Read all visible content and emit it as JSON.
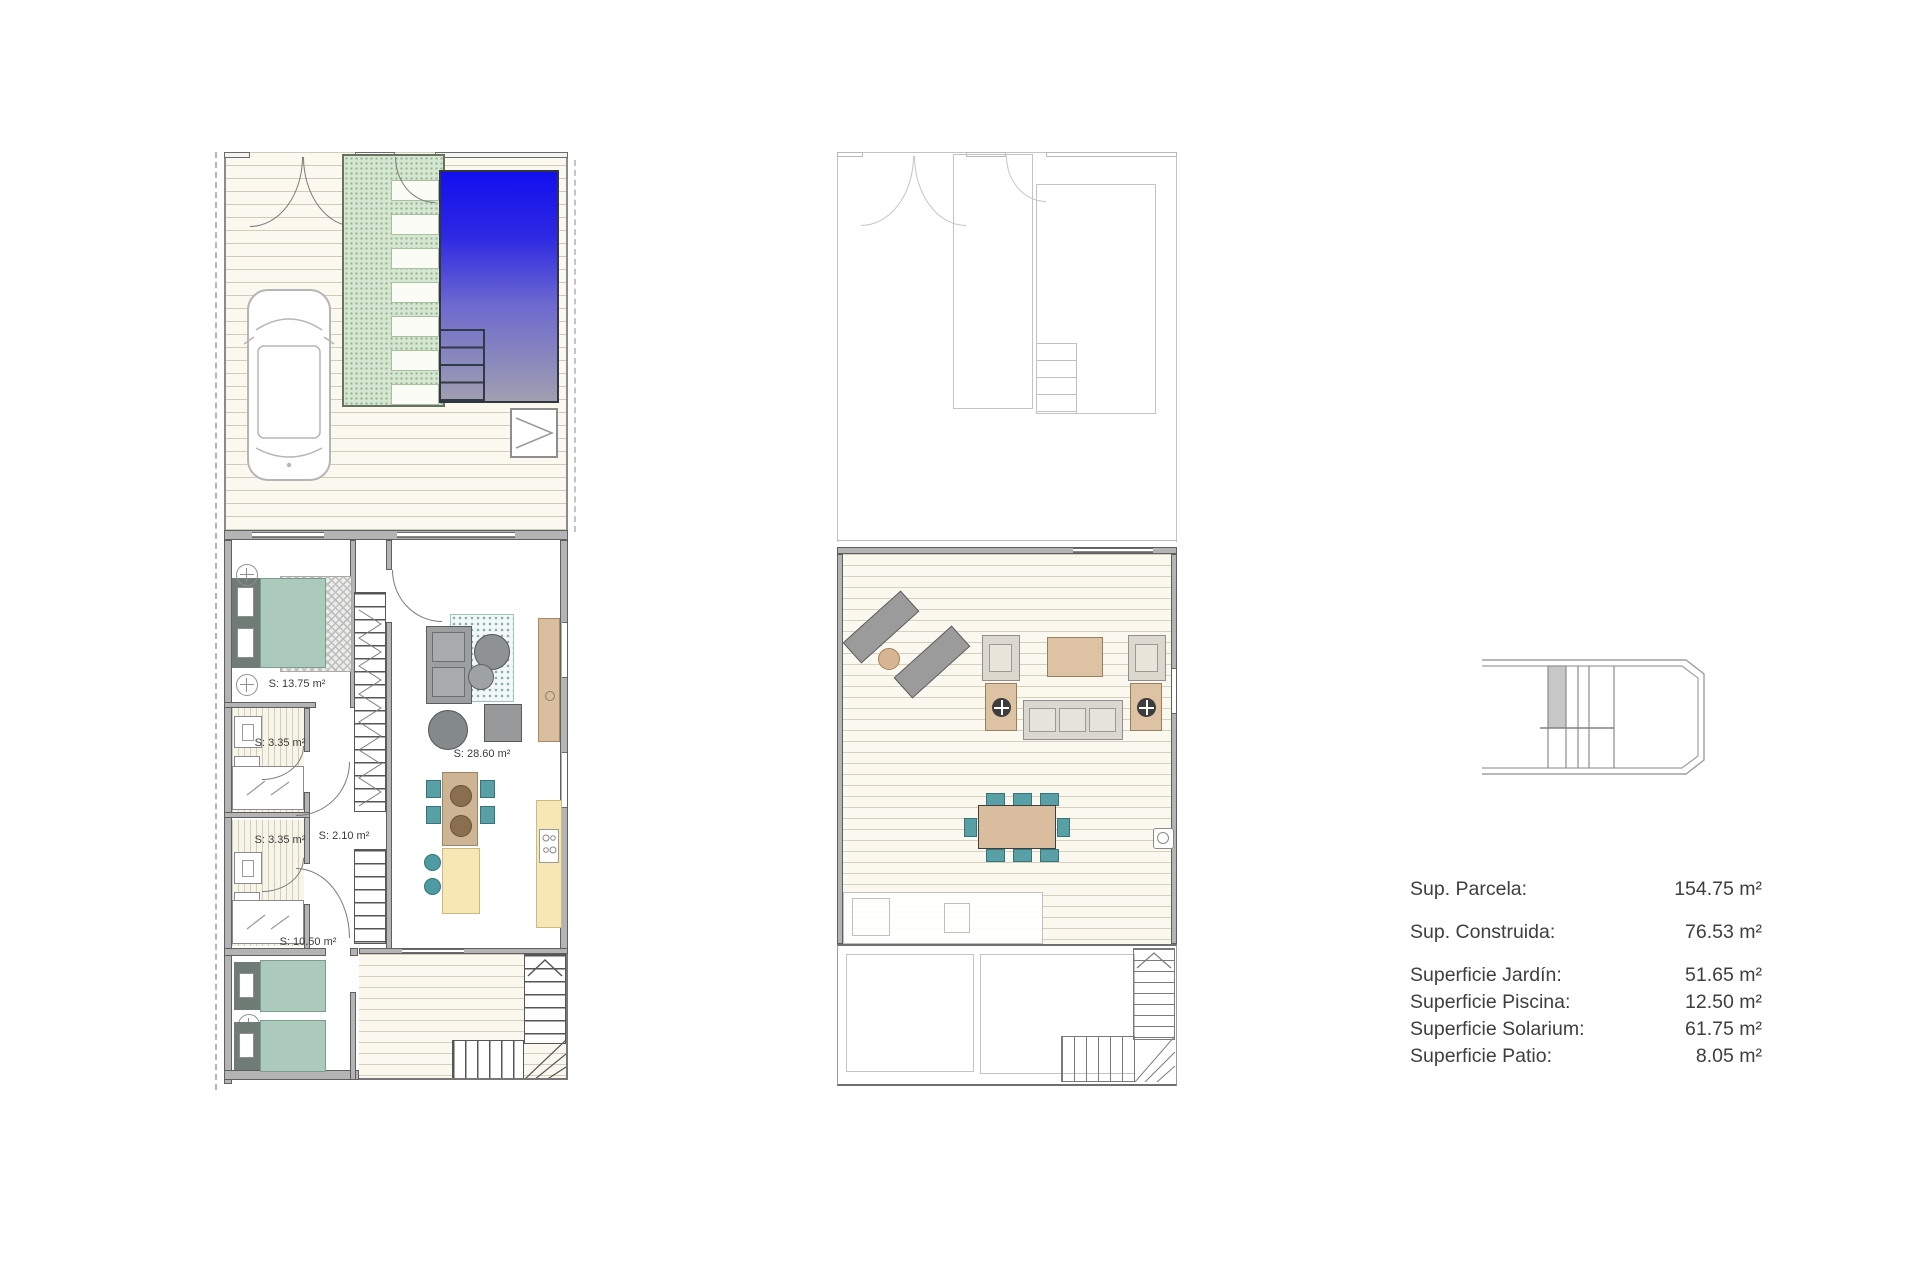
{
  "document": {
    "type": "floor-plan-sheet",
    "background": "#ffffff"
  },
  "plans": {
    "ground_floor": {
      "name": "ground-floor-plan",
      "room_labels": {
        "master_bedroom": "S: 13.75 m²",
        "bathroom_1": "S: 3.35 m²",
        "bathroom_2": "S: 3.35 m²",
        "hallway": "S: 2.10 m²",
        "living_kitchen": "S: 28.60 m²",
        "bedroom_2": "S: 10.50 m²"
      }
    },
    "solarium_floor": {
      "name": "solarium-plan"
    }
  },
  "summary": {
    "rows": [
      {
        "label": "Sup. Parcela:",
        "value": "154.75 m²"
      },
      {
        "label": "Sup. Construida:",
        "value": "76.53 m²"
      },
      {
        "label": "Superficie Jardín:",
        "value": "51.65 m²"
      },
      {
        "label": "Superficie Piscina:",
        "value": "12.50 m²"
      },
      {
        "label": "Superficie Solarium:",
        "value": "61.75 m²"
      },
      {
        "label": "Superficie Patio:",
        "value": "8.05 m²"
      }
    ]
  },
  "colors": {
    "pool_top": "#1410ee",
    "pool_bottom": "#a3a2ae",
    "garden_path_green": "#d6e7d1",
    "deck_cream": "#fbf9ef",
    "furniture_teal": "#58a0a6",
    "bed_teal": "#accabb",
    "wood_tan": "#dec2a4",
    "kitchen_yellow": "#f7e7b5",
    "wall_gray": "#b4b4b4"
  }
}
